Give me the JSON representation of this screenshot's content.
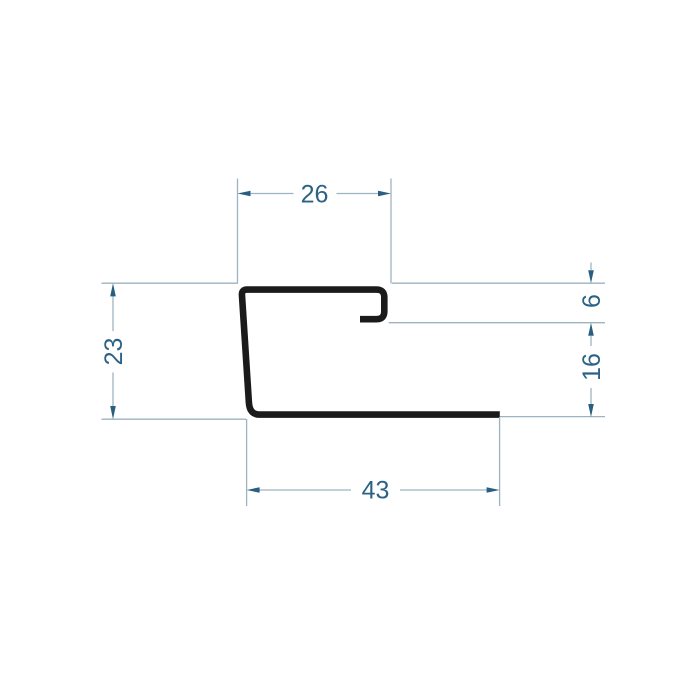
{
  "drawing": {
    "kind": "profile-cross-section-dimension-drawing",
    "background": "#ffffff"
  },
  "dimensions": {
    "top_width": {
      "value": "26"
    },
    "lip_height": {
      "value": "6"
    },
    "opening_height": {
      "value": "16"
    },
    "left_height": {
      "value": "23"
    },
    "bottom_width": {
      "value": "43"
    }
  },
  "colors": {
    "profile_stroke": "#1b1b1b",
    "dimension_line": "#9db3c1",
    "dimension_text": "#2c6385",
    "arrowhead": "#2a5e80"
  }
}
